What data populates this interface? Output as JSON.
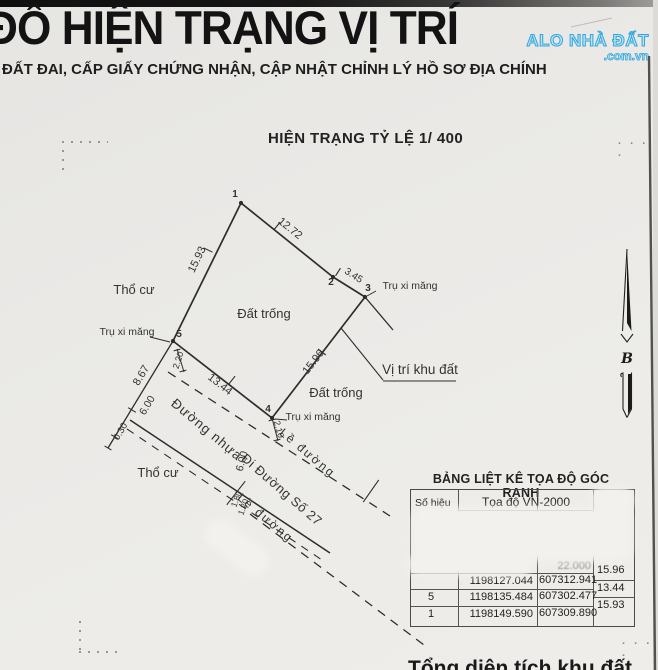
{
  "header": {
    "title": "ĐỒ HIỆN TRẠNG VỊ TRÍ",
    "subtitle": "ĐẤT ĐAI, CẤP GIẤY CHỨNG NHẬN, CẬP NHẬT CHỈNH LÝ HỒ SƠ ĐỊA CHÍNH",
    "scale_caption": "HIỆN TRẠNG TỶ LỆ 1/ 400",
    "watermark_line1": "ALO NHÀ ĐẤT",
    "watermark_line2": ".com.vn",
    "watermark_color": "#36a7db"
  },
  "diagram": {
    "north_label": "B",
    "ink_color": "#2e2d2b",
    "vertices": [
      {
        "x": 241,
        "y": 203
      },
      {
        "x": 333,
        "y": 277
      },
      {
        "x": 365,
        "y": 297
      },
      {
        "x": 272,
        "y": 418
      },
      {
        "x": 173,
        "y": 341
      }
    ],
    "lines": [
      {
        "x1": 241,
        "y1": 203,
        "x2": 333,
        "y2": 277,
        "w": 1.7
      },
      {
        "x1": 333,
        "y1": 277,
        "x2": 365,
        "y2": 297,
        "w": 1.7
      },
      {
        "x1": 365,
        "y1": 297,
        "x2": 272,
        "y2": 418,
        "w": 1.7
      },
      {
        "x1": 272,
        "y1": 418,
        "x2": 173,
        "y2": 341,
        "w": 1.7
      },
      {
        "x1": 173,
        "y1": 341,
        "x2": 241,
        "y2": 203,
        "w": 1.7
      },
      {
        "x1": 365,
        "y1": 297,
        "x2": 393,
        "y2": 330,
        "w": 1.3
      },
      {
        "x1": 173,
        "y1": 341,
        "x2": 108,
        "y2": 448,
        "w": 1.3
      },
      {
        "x1": 130,
        "y1": 420,
        "x2": 330,
        "y2": 553,
        "w": 1.5
      },
      {
        "x1": 127,
        "y1": 429,
        "x2": 322,
        "y2": 560,
        "w": 1.1,
        "dash": "8,7"
      },
      {
        "x1": 168,
        "y1": 372,
        "x2": 390,
        "y2": 516,
        "w": 1.3,
        "dash": "9,7"
      },
      {
        "x1": 250,
        "y1": 514,
        "x2": 428,
        "y2": 648,
        "w": 1.3,
        "dash": "9,7"
      },
      {
        "x1": 272,
        "y1": 418,
        "x2": 278,
        "y2": 441,
        "w": 1
      },
      {
        "x1": 177,
        "y1": 349,
        "x2": 184,
        "y2": 372,
        "w": 1
      },
      {
        "x1": 376,
        "y1": 291,
        "x2": 367,
        "y2": 296,
        "w": 1
      },
      {
        "x1": 150,
        "y1": 337,
        "x2": 170,
        "y2": 342,
        "w": 1
      },
      {
        "x1": 287,
        "y1": 420,
        "x2": 275,
        "y2": 419,
        "w": 1
      },
      {
        "x1": 383,
        "y1": 380,
        "x2": 341,
        "y2": 328,
        "w": 1.1
      },
      {
        "x1": 383,
        "y1": 381,
        "x2": 456,
        "y2": 381,
        "w": 1.1
      },
      {
        "x1": 649,
        "y1": 56,
        "x2": 655,
        "y2": 670,
        "w": 2.4,
        "c": "#53514d"
      },
      {
        "x1": 571,
        "y1": 27,
        "x2": 612,
        "y2": 18,
        "w": 1,
        "c": "#bdbcb8"
      }
    ],
    "ticks": [
      {
        "x": 277,
        "y": 226,
        "a": -51,
        "len": 10
      },
      {
        "x": 208,
        "y": 250,
        "a": 26,
        "len": 10
      },
      {
        "x": 338,
        "y": 272,
        "a": -57,
        "len": 9
      },
      {
        "x": 322,
        "y": 352,
        "a": 38,
        "len": 10
      },
      {
        "x": 232,
        "y": 380,
        "a": -52,
        "len": 10
      },
      {
        "x": 132,
        "y": 410,
        "a": 31,
        "len": 9
      },
      {
        "x": 115,
        "y": 437,
        "a": 31,
        "len": 9
      },
      {
        "x": 108,
        "y": 448,
        "a": 31,
        "len": 8
      },
      {
        "x": 236,
        "y": 493,
        "a": -52,
        "len": 30
      },
      {
        "x": 371,
        "y": 491,
        "a": -55,
        "len": 27
      },
      {
        "x": 272,
        "y": 420,
        "a": -15,
        "len": 7
      },
      {
        "x": 277,
        "y": 440,
        "a": -15,
        "len": 7
      },
      {
        "x": 177,
        "y": 350,
        "a": -15,
        "len": 7
      },
      {
        "x": 183,
        "y": 371,
        "a": -15,
        "len": 7
      }
    ],
    "labels": [
      {
        "t": "12.72",
        "x": 288,
        "y": 231,
        "r": 39,
        "s": 11
      },
      {
        "t": "3.45",
        "x": 352,
        "y": 278,
        "r": 33,
        "s": 10
      },
      {
        "t": "15.96",
        "x": 316,
        "y": 364,
        "r": -52,
        "s": 11
      },
      {
        "t": "13.44",
        "x": 218,
        "y": 387,
        "r": 38,
        "s": 11
      },
      {
        "t": "15.93",
        "x": 200,
        "y": 261,
        "r": -64,
        "s": 11
      },
      {
        "t": "8.67",
        "x": 144,
        "y": 377,
        "r": -59,
        "s": 11
      },
      {
        "t": "6.00",
        "x": 150,
        "y": 407,
        "r": -59,
        "s": 10.5
      },
      {
        "t": "0.30",
        "x": 123,
        "y": 433,
        "r": -59,
        "s": 9.5
      },
      {
        "t": "2.20",
        "x": 181,
        "y": 361,
        "r": -72,
        "s": 9
      },
      {
        "t": "2.10",
        "x": 276,
        "y": 430,
        "r": 75,
        "s": 9
      },
      {
        "t": "6.00",
        "x": 245,
        "y": 462,
        "r": -75,
        "s": 10.5
      },
      {
        "t": "1.80",
        "x": 239,
        "y": 500,
        "r": -70,
        "s": 8.5
      },
      {
        "t": "1.20",
        "x": 246,
        "y": 508,
        "r": -70,
        "s": 8.5
      },
      {
        "t": "Thổ cư",
        "x": 134,
        "y": 294,
        "r": 0,
        "s": 13
      },
      {
        "t": "Thổ cư",
        "x": 158,
        "y": 477,
        "r": 0,
        "s": 13
      },
      {
        "t": "Đất trống",
        "x": 264,
        "y": 318,
        "r": 0,
        "s": 13
      },
      {
        "t": "Đất trống",
        "x": 336,
        "y": 397,
        "r": 0,
        "s": 13
      },
      {
        "t": "Đường nhựa",
        "x": 204,
        "y": 433,
        "r": 40,
        "s": 13.5,
        "ls": 1
      },
      {
        "t": "Đi Đường Số 27",
        "x": 279,
        "y": 493,
        "r": 41,
        "s": 13,
        "ls": 0.5
      },
      {
        "t": "Lề  đường",
        "x": 305,
        "y": 456,
        "r": 40,
        "s": 12,
        "ls": 2
      },
      {
        "t": "Lề  đường",
        "x": 263,
        "y": 521,
        "r": 40,
        "s": 12,
        "ls": 2
      },
      {
        "t": "Vị trí khu đất",
        "x": 420,
        "y": 374,
        "r": 0,
        "s": 13.5
      },
      {
        "t": "Trụ xi măng",
        "x": 410,
        "y": 289,
        "r": 0,
        "s": 10.5
      },
      {
        "t": "Trụ xi măng",
        "x": 127,
        "y": 335,
        "r": 0,
        "s": 10.5
      },
      {
        "t": "Trụ xi măng",
        "x": 313,
        "y": 420,
        "r": 0,
        "s": 10.5
      },
      {
        "t": "1",
        "x": 235,
        "y": 197,
        "r": 0,
        "s": 10,
        "b": 1
      },
      {
        "t": "2",
        "x": 331,
        "y": 285,
        "r": 0,
        "s": 10,
        "b": 1
      },
      {
        "t": "3",
        "x": 368,
        "y": 291,
        "r": 0,
        "s": 10,
        "b": 1
      },
      {
        "t": "4",
        "x": 268,
        "y": 412,
        "r": 0,
        "s": 10,
        "b": 1
      },
      {
        "t": "5",
        "x": 179,
        "y": 337,
        "r": 0,
        "s": 10,
        "b": 1
      }
    ]
  },
  "table": {
    "title": "BẢNG LIỆT KÊ TỌA ĐỘ GÓC RANH",
    "col_header_id": "Số hiệu",
    "col_header_coord": "Tọa độ VN-2000",
    "rows": [
      {
        "id": "",
        "x": "",
        "y": "22.000"
      },
      {
        "id": "",
        "x": "1198127.044",
        "y": "607312.941"
      },
      {
        "id": "5",
        "x": "1198135.484",
        "y": "607302.477"
      },
      {
        "id": "1",
        "x": "1198149.590",
        "y": "607309.890"
      }
    ],
    "edge_lengths": [
      "15.96",
      "13.44",
      "15.93"
    ]
  },
  "misc": {
    "dots_right": ". . . .",
    "dots_bottom": ". . . .",
    "cutoff_text": "Tổng diện tích khu đất"
  }
}
